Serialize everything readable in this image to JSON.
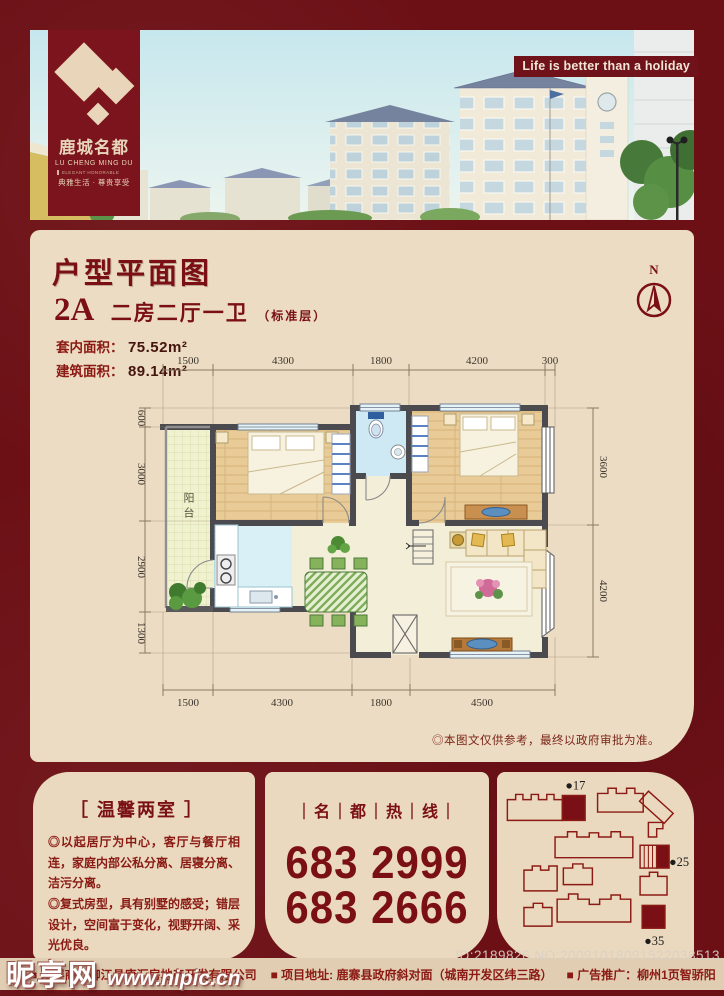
{
  "colors": {
    "maroon_bg": "#6c1016",
    "panel_cream": "#ecdcc3",
    "accent_red": "#7a1016",
    "wall_gray": "#4b4b4f"
  },
  "hero": {
    "slogan": "Life is better than a holiday"
  },
  "logo": {
    "name_cn": "鹿城名都",
    "name_en": "LU CHENG MING DU",
    "sub_en": "ELEGANT HONORABLE",
    "tagline": "典雅生活 · 尊贵享受"
  },
  "plan": {
    "title": "户型平面图",
    "unit_code": "2A",
    "unit_type": "二房二厅一卫",
    "unit_note": "（标准层）",
    "area_inner_label": "套内面积：",
    "area_inner_value": "75.52m²",
    "area_build_label": "建筑面积：",
    "area_build_value": "89.14m²",
    "compass": "N",
    "balcony_label": "阳台",
    "disclaimer": "◎本图文仅供参考，最终以政府审批为准。",
    "dimensions": {
      "top": [
        "1500",
        "4300",
        "1800",
        "4200",
        "300"
      ],
      "bottom": [
        "1500",
        "4300",
        "1800",
        "4500"
      ],
      "left": [
        "600",
        "3000",
        "2900",
        "1300"
      ],
      "right": [
        "3600",
        "4200"
      ]
    }
  },
  "highlights": {
    "title": "［ 温馨两室 ］",
    "bullets": [
      "◎以起居厅为中心，客厅与餐厅相连，家庭内部公私分离、居寝分离、洁污分离。",
      "◎复式房型，具有别墅的感受；错层设计，空间富于变化，视野开阔、采光优良。",
      "◎又有宽畅主卧室充分保证主人的私密生活。"
    ]
  },
  "hotline": {
    "label": "｜名｜都｜热｜线｜",
    "phones": [
      "683 2999",
      "683 2666"
    ]
  },
  "siteplan": {
    "markers": [
      "●17",
      "●25",
      "●35"
    ]
  },
  "footer": {
    "items": [
      "■ 发展商：柳江县康汇房地产开发有限公司",
      "■ 项目地址: 鹿寨县政府斜对面（城南开发区纬三路）",
      "■ 广告推广：柳州1页智骄阳"
    ],
    "id_text": "ID:2189826 NO:20091018091522038513"
  },
  "watermark": {
    "site_name": "昵享网",
    "url": "www.nipic.cn"
  }
}
